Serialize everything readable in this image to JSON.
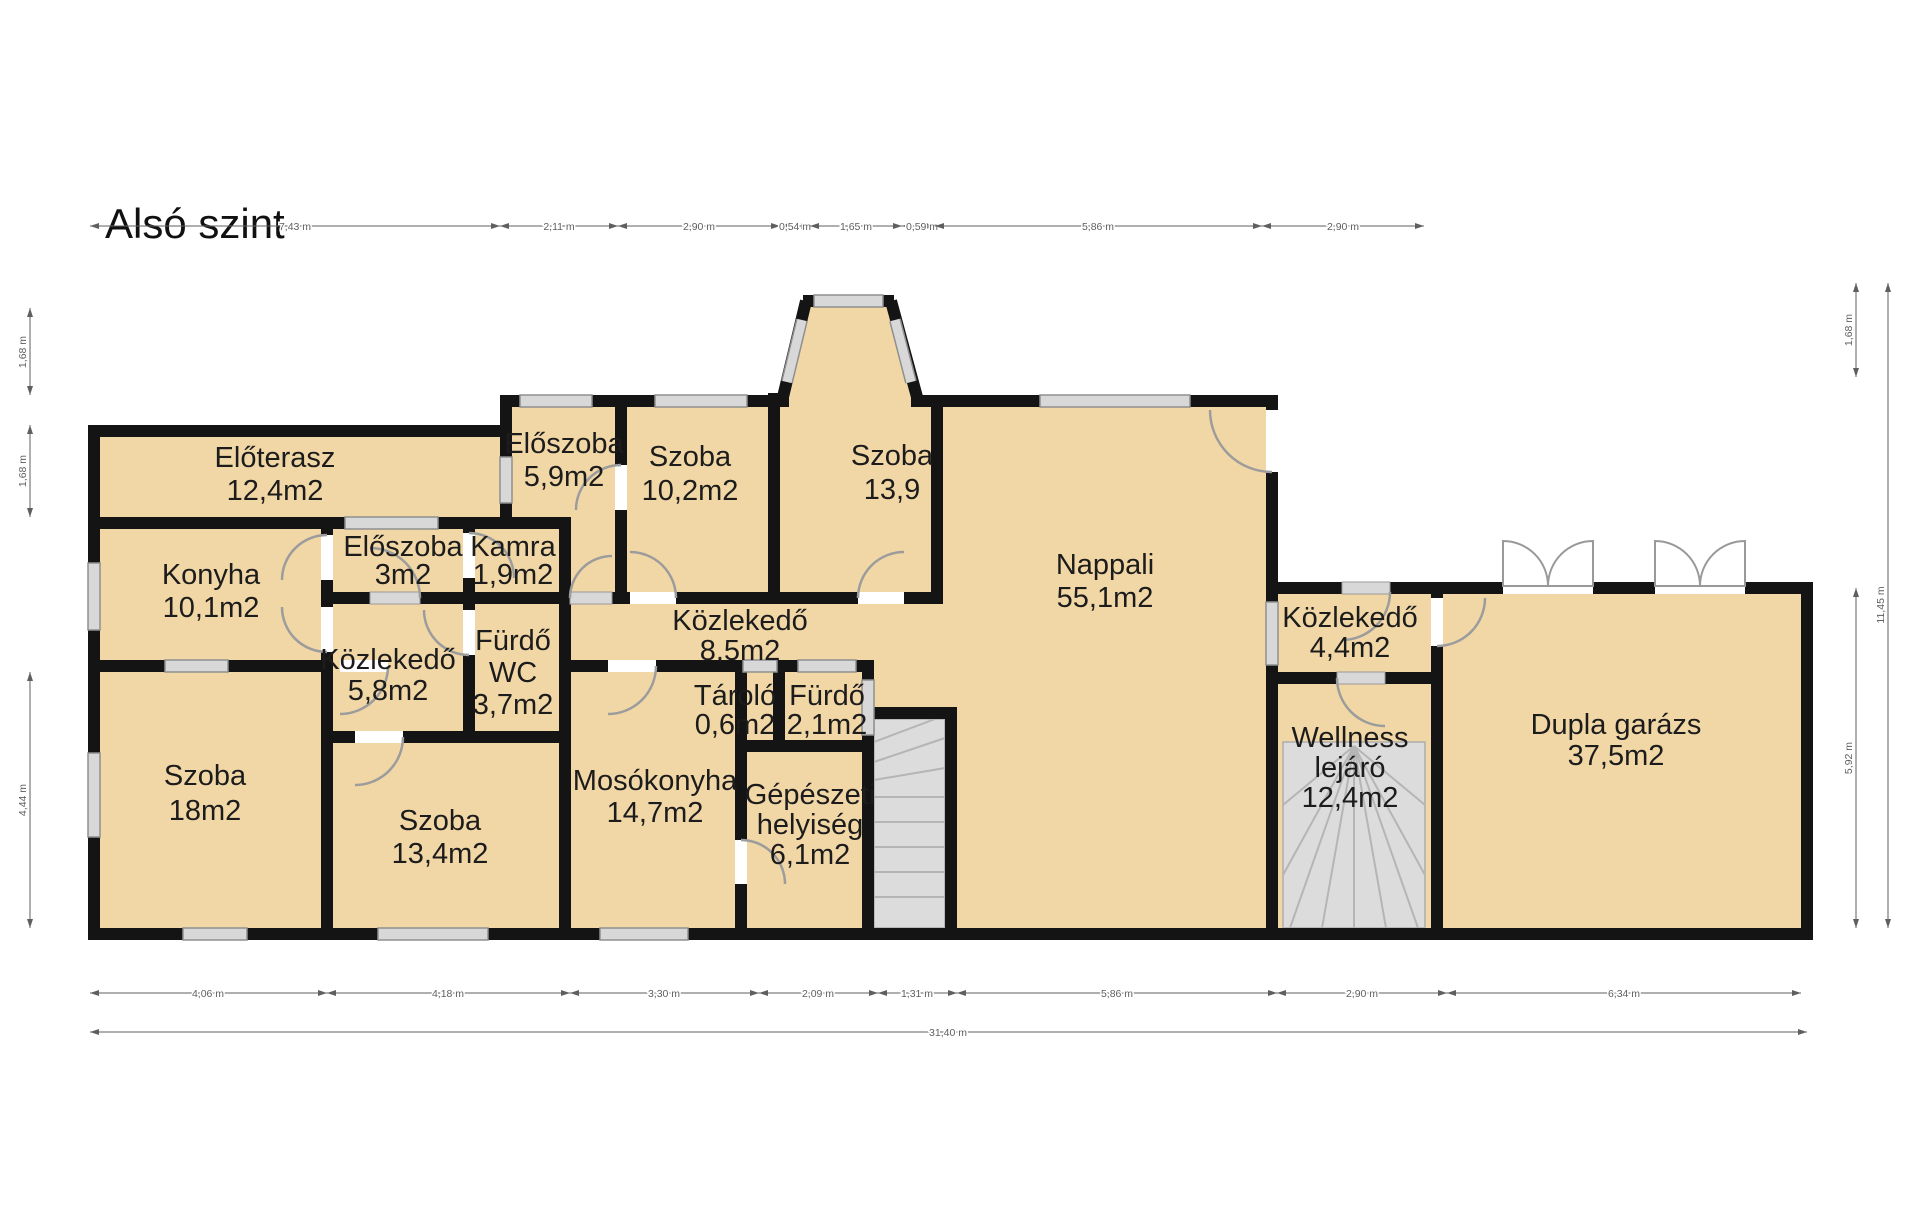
{
  "title": "Alsó szint",
  "rooms": {
    "eloterasz": {
      "lines": [
        "Előterasz",
        "12,4m2"
      ]
    },
    "eloszoba_59": {
      "lines": [
        "Előszoba",
        "5,9m2"
      ]
    },
    "szoba_102": {
      "lines": [
        "Szoba",
        "10,2m2"
      ]
    },
    "szoba_139": {
      "lines": [
        "Szoba",
        "13,9"
      ]
    },
    "nappali": {
      "lines": [
        "Nappali",
        "55,1m2"
      ]
    },
    "konyha": {
      "lines": [
        "Konyha",
        "10,1m2"
      ]
    },
    "eloszoba_3": {
      "lines": [
        "Előszoba",
        "3m2"
      ]
    },
    "kamra": {
      "lines": [
        "Kamra",
        "1,9m2"
      ]
    },
    "kozlekedo_58": {
      "lines": [
        "Közlekedő",
        "5,8m2"
      ]
    },
    "furdo_wc": {
      "lines": [
        "Fürdő",
        "WC",
        "3,7m2"
      ]
    },
    "kozlekedo_85": {
      "lines": [
        "Közlekedő",
        "8,5m2"
      ]
    },
    "szoba_18": {
      "lines": [
        "Szoba",
        "18m2"
      ]
    },
    "szoba_134": {
      "lines": [
        "Szoba",
        "13,4m2"
      ]
    },
    "mosokonyha": {
      "lines": [
        "Mosókonyha",
        "14,7m2"
      ]
    },
    "tarolo": {
      "lines": [
        "Tároló",
        "0,6m2"
      ]
    },
    "furdo_21": {
      "lines": [
        "Fürdő",
        "2,1m2"
      ]
    },
    "gepeszeti": {
      "lines": [
        "Gépészeti",
        "helyiség",
        "6,1m2"
      ]
    },
    "kozlekedo_44": {
      "lines": [
        "Közlekedő",
        "4,4m2"
      ]
    },
    "wellness": {
      "lines": [
        "Wellness",
        "lejáró",
        "12,4m2"
      ]
    },
    "garazs": {
      "lines": [
        "Dupla garázs",
        "37,5m2"
      ]
    }
  },
  "dimensions": {
    "top": [
      "7,43 m",
      "2,11 m",
      "2,90 m",
      "0,54 m",
      "1,65 m",
      "0,59 m",
      "5,86 m",
      "2,90 m"
    ],
    "bottom": [
      "4,06 m",
      "4,18 m",
      "3,30 m",
      "2,09 m",
      "1,31 m",
      "5,86 m",
      "2,90 m",
      "6,34 m"
    ],
    "bottom_total": "31,40 m",
    "left": [
      "1,68 m",
      "1,68 m",
      "4,44 m"
    ],
    "right": [
      "1,68 m",
      "5,92 m",
      "11,45 m"
    ]
  },
  "colors": {
    "room_fill": "#F2D7A6",
    "wall": "#141414",
    "stair_fill": "#DCDCDC",
    "window_fill": "#D8D8D8",
    "door": "#9C9C9C",
    "dimension": "#5F5F5F",
    "room_text": "#1C1C1C"
  }
}
